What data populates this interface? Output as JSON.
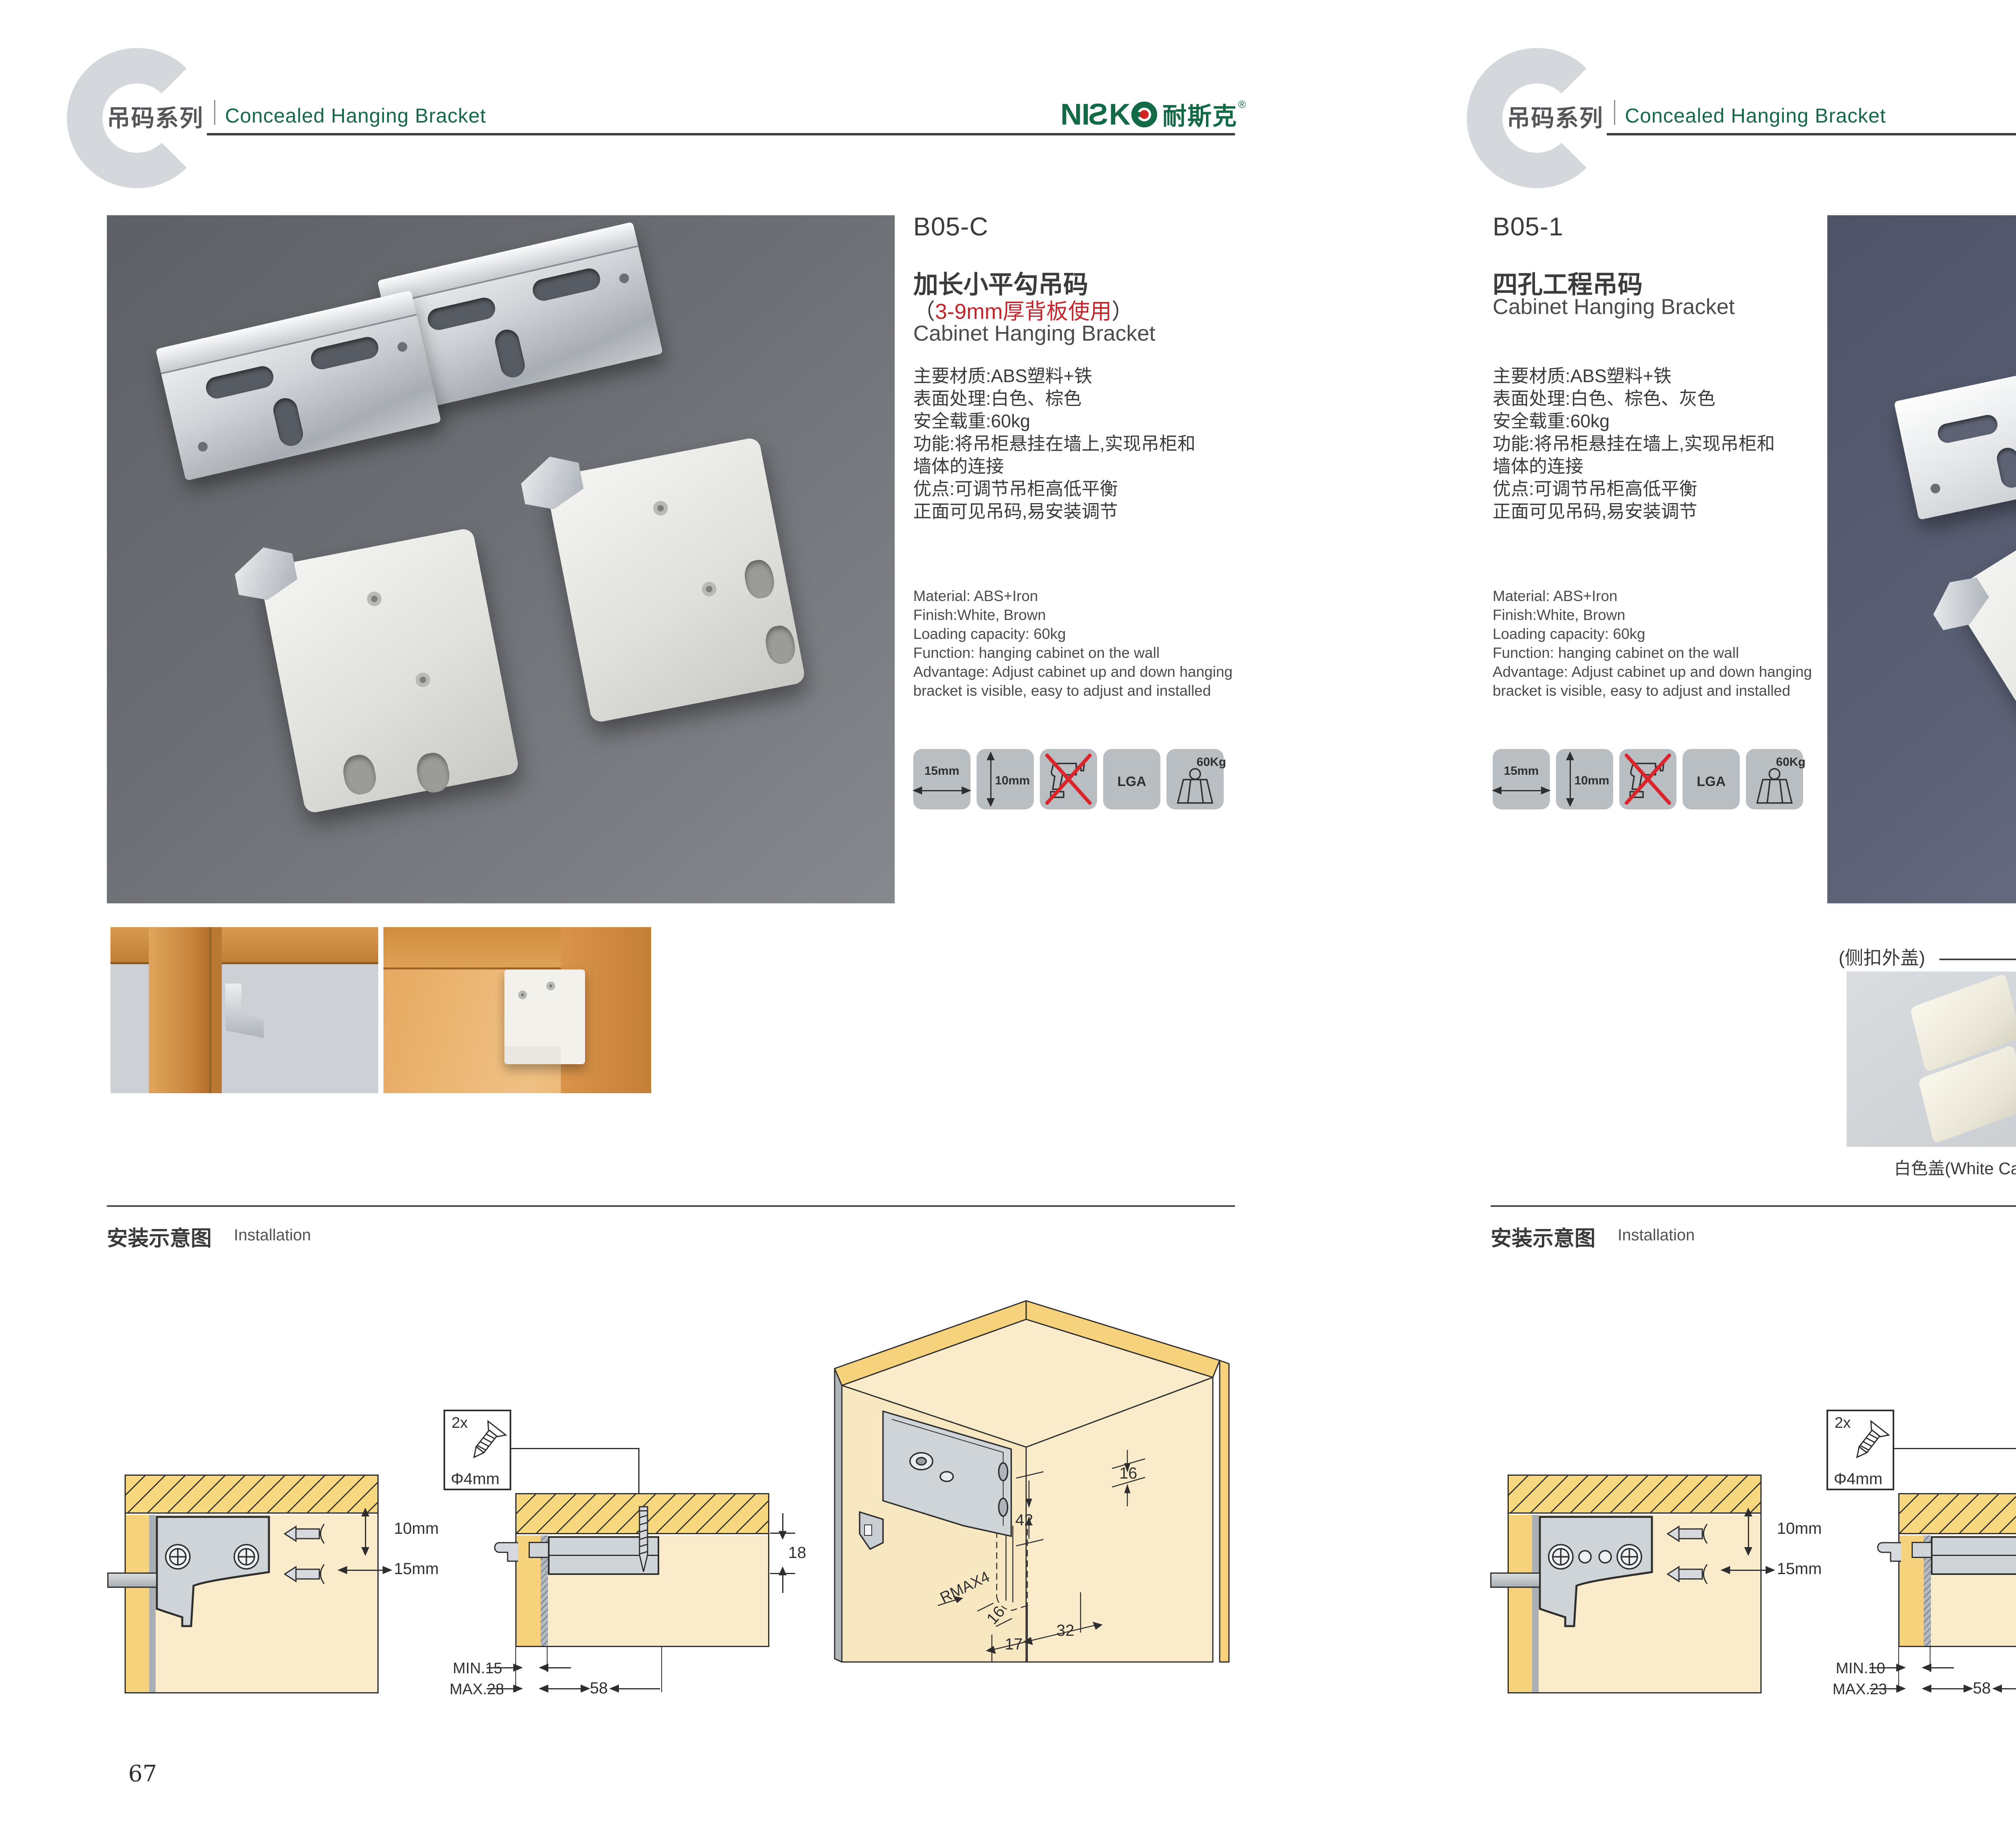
{
  "brand": {
    "l1": "N",
    "l2": "I",
    "l3": "S",
    "l4": "K",
    "cn": "耐斯克",
    "reg": "®"
  },
  "header": {
    "series_cn": "吊码系列",
    "series_en": "Concealed Hanging Bracket"
  },
  "icons": {
    "width_label": "15mm",
    "height_label": "10mm",
    "lga_label": "LGA",
    "load_label": "60Kg"
  },
  "diagrams": {
    "d1": {
      "vertical": "10mm",
      "horizontal": "15mm"
    },
    "d2": {
      "qty": "2x",
      "diameter": "Φ4mm",
      "span": "58",
      "thickness": "18",
      "left_min": "MIN.15",
      "left_max": "MAX.28",
      "right_min": "MIN.10",
      "right_max": "MAX.23"
    },
    "d3": {
      "top_offset": "16",
      "depth": "42",
      "radius": "RMAX4",
      "side_offset": "16",
      "front_offset": "17",
      "pitch": "32"
    }
  },
  "left_page": {
    "page_number": "67",
    "code": "B05-C",
    "title_cn": "加长小平勾吊码",
    "sub_open": "（",
    "sub_red": "3-9mm厚背板使用",
    "sub_close": "）",
    "title_en": "Cabinet Hanging Bracket",
    "specs_cn": [
      "主要材质:ABS塑料+铁",
      "表面处理:白色、棕色",
      "安全载重:60kg",
      "功能:将吊柜悬挂在墙上,实现吊柜和",
      "墙体的连接",
      "优点:可调节吊柜高低平衡",
      "正面可见吊码,易安装调节"
    ],
    "specs_en": [
      "Material: ABS+Iron",
      "Finish:White, Brown",
      "Loading capacity: 60kg",
      "Function: hanging cabinet on the wall",
      "Advantage: Adjust cabinet up and down hanging",
      "bracket is visible, easy to adjust and installed"
    ],
    "install_cn": "安装示意图",
    "install_en": "Installation"
  },
  "right_page": {
    "page_number": "68",
    "code": "B05-1",
    "title_cn": "四孔工程吊码",
    "title_en": "Cabinet Hanging Bracket",
    "specs_cn": [
      "主要材质:ABS塑料+铁",
      "表面处理:白色、棕色、灰色",
      "安全载重:60kg",
      "功能:将吊柜悬挂在墙上,实现吊柜和",
      "墙体的连接",
      "优点:可调节吊柜高低平衡",
      "正面可见吊码,易安装调节"
    ],
    "specs_en": [
      "Material: ABS+Iron",
      "Finish:White, Brown",
      "Loading capacity: 60kg",
      "Function: hanging cabinet on the wall",
      "Advantage: Adjust cabinet up and down hanging",
      "bracket is visible, easy to adjust and installed"
    ],
    "caps_section_label": "(侧扣外盖)",
    "caps": [
      {
        "label": "白色盖(White Cap)"
      },
      {
        "label": "灰色盖(Gray Cap)"
      },
      {
        "label": "棕色盖(Silver Cap)"
      }
    ],
    "install_cn": "安装示意图",
    "install_en": "Installation"
  }
}
